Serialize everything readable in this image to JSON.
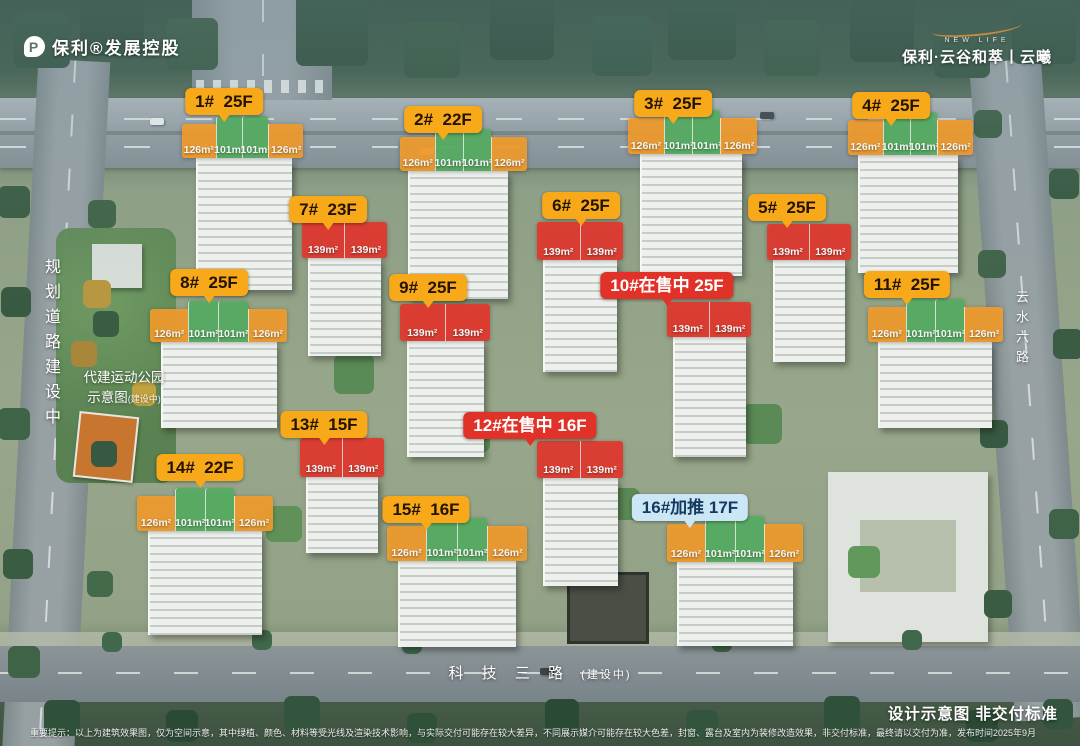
{
  "brand": {
    "logo_left_text": "保利®发展控股",
    "logo_left_mark": "P",
    "logo_right_sub": "NEW LIFE",
    "logo_right_text": "保利·云谷和萃丨云曦"
  },
  "labels": {
    "planned_road": "规划道路建设中",
    "park_line1": "代建运动公园",
    "park_line2": "示意图",
    "park_line2_note": "(建设中)",
    "right_road": "云水六路",
    "bottom_road": "科 技 三 路",
    "bottom_road_note": "(建设中)",
    "footer_title": "设计示意图 非交付标准",
    "disclaimer": "重要提示：以上为建筑效果图，仅为空间示意，其中绿植、颜色、材料等受光线及渲染技术影响，与实际交付可能存在较大差异，不同展示媒介可能存在较大色差，封窗、露台及室内为装修改造效果，非交付标准，最终请以交付为准，发布时间2025年9月"
  },
  "colors": {
    "label_yellow": "#F7A919",
    "label_yellow_text": "#221400",
    "label_red": "#E03228",
    "label_red_text": "#FFFFFF",
    "label_blue": "#CBE6F4",
    "label_blue_text": "#14395F",
    "unit_orange": "#F09C2E",
    "unit_green": "#57AE63",
    "unit_red": "#E2392F"
  },
  "buildings": [
    {
      "name": "1",
      "label": "1#  25F",
      "type": "yellow",
      "cx": 224,
      "ly": 88,
      "plan": {
        "x": 182,
        "y": 124,
        "w": 121,
        "h": 34
      },
      "tower": {
        "x": 196,
        "y": 158,
        "w": 94,
        "h": 132
      },
      "units": [
        {
          "t": "126m²",
          "c": "orange"
        },
        {
          "t": "101m²",
          "c": "green"
        },
        {
          "t": "101m²",
          "c": "green"
        },
        {
          "t": "126m²",
          "c": "orange"
        }
      ]
    },
    {
      "name": "2",
      "label": "2#  22F",
      "type": "yellow",
      "cx": 443,
      "ly": 106,
      "plan": {
        "x": 400,
        "y": 137,
        "w": 127,
        "h": 34
      },
      "tower": {
        "x": 408,
        "y": 171,
        "w": 98,
        "h": 128
      },
      "units": [
        {
          "t": "126m²",
          "c": "orange"
        },
        {
          "t": "101m²",
          "c": "green"
        },
        {
          "t": "101m²",
          "c": "green"
        },
        {
          "t": "126m²",
          "c": "orange"
        }
      ]
    },
    {
      "name": "3",
      "label": "3#  25F",
      "type": "yellow",
      "cx": 673,
      "ly": 90,
      "plan": {
        "x": 628,
        "y": 118,
        "w": 129,
        "h": 36
      },
      "tower": {
        "x": 640,
        "y": 154,
        "w": 100,
        "h": 122
      },
      "units": [
        {
          "t": "126m²",
          "c": "orange"
        },
        {
          "t": "101m²",
          "c": "green"
        },
        {
          "t": "101m²",
          "c": "green"
        },
        {
          "t": "126m²",
          "c": "orange"
        }
      ]
    },
    {
      "name": "4",
      "label": "4#  25F",
      "type": "yellow",
      "cx": 891,
      "ly": 92,
      "plan": {
        "x": 848,
        "y": 120,
        "w": 125,
        "h": 35
      },
      "tower": {
        "x": 858,
        "y": 155,
        "w": 98,
        "h": 118
      },
      "units": [
        {
          "t": "126m²",
          "c": "orange"
        },
        {
          "t": "101m²",
          "c": "green"
        },
        {
          "t": "101m²",
          "c": "green"
        },
        {
          "t": "126m²",
          "c": "orange"
        }
      ]
    },
    {
      "name": "5",
      "label": "5#  25F",
      "type": "yellow",
      "cx": 787,
      "ly": 194,
      "plan": {
        "x": 767,
        "y": 224,
        "w": 84,
        "h": 36
      },
      "tower": {
        "x": 773,
        "y": 260,
        "w": 70,
        "h": 102
      },
      "units": [
        {
          "t": "139m²",
          "c": "red"
        },
        {
          "t": "139m²",
          "c": "red"
        }
      ]
    },
    {
      "name": "6",
      "label": "6#  25F",
      "type": "yellow",
      "cx": 581,
      "ly": 192,
      "plan": {
        "x": 537,
        "y": 222,
        "w": 86,
        "h": 38
      },
      "tower": {
        "x": 543,
        "y": 260,
        "w": 72,
        "h": 112
      },
      "units": [
        {
          "t": "139m²",
          "c": "red"
        },
        {
          "t": "139m²",
          "c": "red"
        }
      ]
    },
    {
      "name": "7",
      "label": "7#  23F",
      "type": "yellow",
      "cx": 328,
      "ly": 196,
      "plan": {
        "x": 302,
        "y": 222,
        "w": 85,
        "h": 36
      },
      "tower": {
        "x": 308,
        "y": 258,
        "w": 71,
        "h": 98
      },
      "units": [
        {
          "t": "139m²",
          "c": "red"
        },
        {
          "t": "139m²",
          "c": "red"
        }
      ]
    },
    {
      "name": "8",
      "label": "8#  25F",
      "type": "yellow",
      "cx": 209,
      "ly": 269,
      "plan": {
        "x": 150,
        "y": 309,
        "w": 137,
        "h": 33
      },
      "tower": {
        "x": 161,
        "y": 342,
        "w": 114,
        "h": 86
      },
      "units": [
        {
          "t": "126m²",
          "c": "orange"
        },
        {
          "t": "101m²",
          "c": "green"
        },
        {
          "t": "101m²",
          "c": "green"
        },
        {
          "t": "126m²",
          "c": "orange"
        }
      ]
    },
    {
      "name": "9",
      "label": "9#  25F",
      "type": "yellow",
      "cx": 428,
      "ly": 274,
      "plan": {
        "x": 400,
        "y": 304,
        "w": 90,
        "h": 37
      },
      "tower": {
        "x": 407,
        "y": 341,
        "w": 75,
        "h": 116
      },
      "units": [
        {
          "t": "139m²",
          "c": "red"
        },
        {
          "t": "139m²",
          "c": "red"
        }
      ]
    },
    {
      "name": "10",
      "label": "10#在售中 25F",
      "type": "red",
      "cx": 667,
      "ly": 272,
      "plan": {
        "x": 667,
        "y": 302,
        "w": 84,
        "h": 35
      },
      "tower": {
        "x": 673,
        "y": 337,
        "w": 71,
        "h": 120
      },
      "units": [
        {
          "t": "139m²",
          "c": "red"
        },
        {
          "t": "139m²",
          "c": "red"
        }
      ]
    },
    {
      "name": "11",
      "label": "11#  25F",
      "type": "yellow",
      "cx": 907,
      "ly": 271,
      "plan": {
        "x": 868,
        "y": 307,
        "w": 135,
        "h": 35
      },
      "tower": {
        "x": 878,
        "y": 342,
        "w": 112,
        "h": 86
      },
      "units": [
        {
          "t": "126m²",
          "c": "orange"
        },
        {
          "t": "101m²",
          "c": "green"
        },
        {
          "t": "101m²",
          "c": "green"
        },
        {
          "t": "126m²",
          "c": "orange"
        }
      ]
    },
    {
      "name": "12",
      "label": "12#在售中 16F",
      "type": "red",
      "cx": 530,
      "ly": 412,
      "plan": {
        "x": 537,
        "y": 441,
        "w": 86,
        "h": 37
      },
      "tower": {
        "x": 543,
        "y": 478,
        "w": 73,
        "h": 108
      },
      "units": [
        {
          "t": "139m²",
          "c": "red"
        },
        {
          "t": "139m²",
          "c": "red"
        }
      ]
    },
    {
      "name": "13",
      "label": "13#  15F",
      "type": "yellow",
      "cx": 324,
      "ly": 411,
      "plan": {
        "x": 300,
        "y": 438,
        "w": 84,
        "h": 39
      },
      "tower": {
        "x": 306,
        "y": 477,
        "w": 70,
        "h": 76
      },
      "units": [
        {
          "t": "139m²",
          "c": "red"
        },
        {
          "t": "139m²",
          "c": "red"
        }
      ]
    },
    {
      "name": "14",
      "label": "14#  22F",
      "type": "yellow",
      "cx": 200,
      "ly": 454,
      "plan": {
        "x": 137,
        "y": 496,
        "w": 136,
        "h": 35
      },
      "tower": {
        "x": 148,
        "y": 531,
        "w": 112,
        "h": 104
      },
      "units": [
        {
          "t": "126m²",
          "c": "orange"
        },
        {
          "t": "101m²",
          "c": "green"
        },
        {
          "t": "101m²",
          "c": "green"
        },
        {
          "t": "126m²",
          "c": "orange"
        }
      ]
    },
    {
      "name": "15",
      "label": "15#  16F",
      "type": "yellow",
      "cx": 426,
      "ly": 496,
      "plan": {
        "x": 387,
        "y": 526,
        "w": 140,
        "h": 35
      },
      "tower": {
        "x": 398,
        "y": 561,
        "w": 116,
        "h": 86
      },
      "units": [
        {
          "t": "126m²",
          "c": "orange"
        },
        {
          "t": "101m²",
          "c": "green"
        },
        {
          "t": "101m²",
          "c": "green"
        },
        {
          "t": "126m²",
          "c": "orange"
        }
      ]
    },
    {
      "name": "16",
      "label": "16#加推 17F",
      "type": "blue",
      "cx": 690,
      "ly": 494,
      "plan": {
        "x": 667,
        "y": 524,
        "w": 136,
        "h": 38
      },
      "tower": {
        "x": 677,
        "y": 562,
        "w": 114,
        "h": 84
      },
      "units": [
        {
          "t": "126m²",
          "c": "orange"
        },
        {
          "t": "101m²",
          "c": "green"
        },
        {
          "t": "101m²",
          "c": "green"
        },
        {
          "t": "126m²",
          "c": "orange"
        }
      ]
    }
  ]
}
